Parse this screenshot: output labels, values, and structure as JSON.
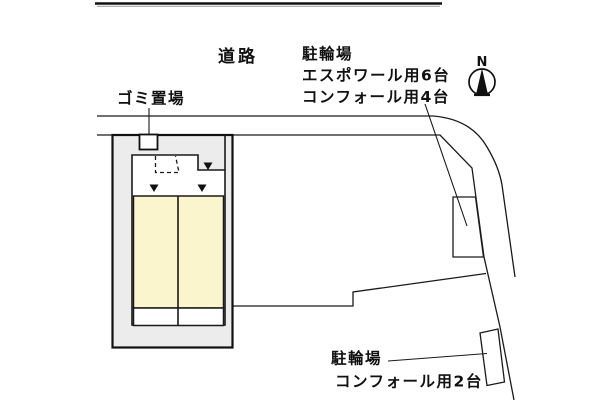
{
  "title": "site-layout-plan",
  "labels": {
    "road": "道路",
    "garbage": "ゴミ置場",
    "compass_n": "N",
    "bike_parking_top": {
      "heading": "駐輪場",
      "line_espoir": "エスポワール用6台",
      "line_comfort": "コンフォール用4台"
    },
    "bike_parking_bottom": {
      "heading": "駐輪場",
      "line_comfort": "コンフォール用2台"
    }
  },
  "colors": {
    "plot_fill": "#ececec",
    "building_fill": "#ffffff",
    "unit_fill": "#fbf5ce",
    "entry_strip_fill": "#ffffff",
    "garbage_box_fill": "#ffffff",
    "marker_fill": "#111111",
    "line": "#1a1a1a"
  },
  "icons": {
    "compass": "compass-north-icon",
    "entrance_markers": "entrance-triangle-icon"
  }
}
